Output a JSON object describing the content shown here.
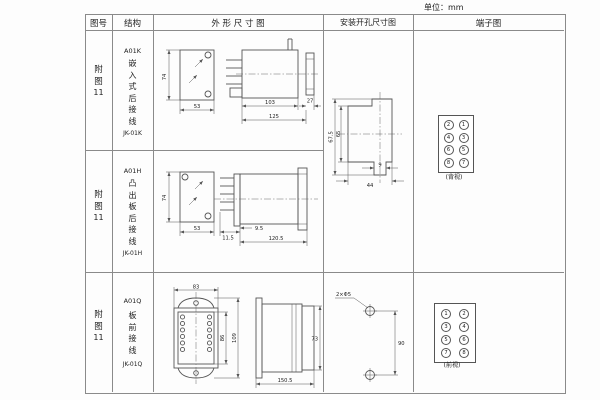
{
  "page": {
    "unit_note": "单位：mm"
  },
  "header": {
    "fig_no": "图号",
    "structure": "结构",
    "outline": "外 形 尺 寸 图",
    "mounting": "安装开孔尺寸图",
    "terminal": "端子图"
  },
  "rows": [
    {
      "fig": "附图",
      "fig_num": "11",
      "model": "A01K",
      "desc": "嵌入式后接线",
      "code": "JK-01K"
    },
    {
      "fig": "附图",
      "fig_num": "11",
      "model": "A01H",
      "desc": "凸出板后接线",
      "code": "JK-01H"
    },
    {
      "fig": "附图",
      "fig_num": "11",
      "model": "A01Q",
      "desc": "板前接线",
      "code": "JK-01Q"
    }
  ],
  "outline1": {
    "front_h": "74",
    "front_w": "53",
    "body_len": "103",
    "tab_len": "27",
    "total_len": "125"
  },
  "outline2": {
    "front_h": "74",
    "front_w": "53",
    "offset": "9.5",
    "body_len": "120.5",
    "pin_len": "11.5"
  },
  "outline3": {
    "top_w": "83",
    "inner_h": "86",
    "outer_h": "109",
    "depth": "150.5",
    "side_h": "73"
  },
  "mounting12": {
    "outer_h": "67.5",
    "inner_h": "65",
    "notch_w": "9",
    "cutout_w": "44"
  },
  "mounting3": {
    "hole_label": "2×Φ5",
    "spacing": "90"
  },
  "terminal12": {
    "cells": [
      "2",
      "1",
      "4",
      "3",
      "6",
      "5",
      "8",
      "7"
    ],
    "view": "(背视)"
  },
  "terminal3": {
    "cells": [
      "1",
      "2",
      "3",
      "4",
      "5",
      "6",
      "7",
      "8"
    ],
    "view": "(前视)"
  }
}
